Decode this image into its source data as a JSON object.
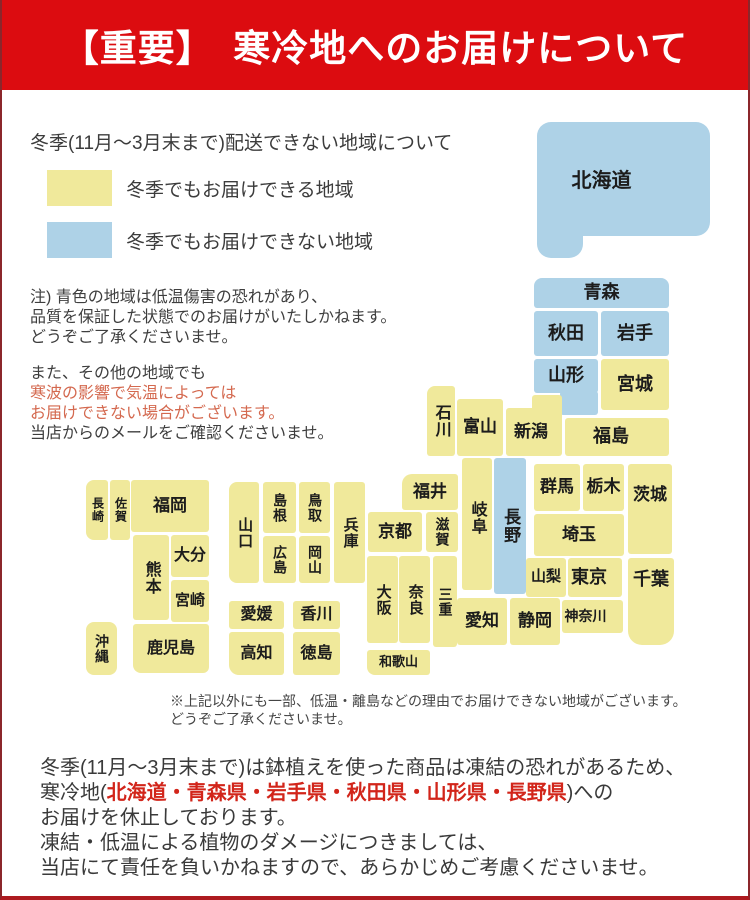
{
  "banner": {
    "title": "【重要】　寒冷地へのお届けについて",
    "bg": "#dc0c10"
  },
  "intro": {
    "heading": "冬季(11月〜3月末まで)配送できない地域について",
    "legend": [
      {
        "key": "deliverable",
        "label": "冬季でもお届けできる地域"
      },
      {
        "key": "not_deliverable",
        "label": "冬季でもお届けできない地域"
      }
    ]
  },
  "notes": {
    "note1": [
      {
        "text": "注) 青色の地域は低温傷害の恐れがあり、"
      },
      {
        "text": "品質を保証した状態でのお届けがいたしかねます。"
      },
      {
        "text": "どうぞご了承くださいませ。"
      }
    ],
    "note2": [
      {
        "text": "また、その他の地域でも"
      },
      {
        "text": "寒波の影響で気温によっては",
        "red": true
      },
      {
        "text": "お届けできない場合がございます。",
        "red": true
      },
      {
        "text": "当店からのメールをご確認くださいませ。"
      }
    ]
  },
  "map": {
    "colors": {
      "deliverable": "#f0e99b",
      "not_deliverable": "#aed2e7"
    },
    "blocks": [
      {
        "id": "hokkaido",
        "label": "北海道",
        "x": 535,
        "y": 122,
        "w": 173,
        "h": 114,
        "c": "b",
        "fs": 20,
        "r": "14px",
        "dx": -22,
        "dy": 3
      },
      {
        "id": "hokkaido-tab",
        "x": 535,
        "y": 200,
        "w": 46,
        "h": 58,
        "c": "b",
        "r": "0 0 14px 14px"
      },
      {
        "id": "aomori",
        "label": "青森",
        "x": 532,
        "y": 278,
        "w": 135,
        "h": 30,
        "c": "b",
        "fs": 18,
        "r": "8px 8px 3px 3px"
      },
      {
        "id": "akita",
        "label": "秋田",
        "x": 532,
        "y": 311,
        "w": 64,
        "h": 45,
        "c": "b",
        "fs": 18
      },
      {
        "id": "iwate",
        "label": "岩手",
        "x": 599,
        "y": 311,
        "w": 68,
        "h": 45,
        "c": "b",
        "fs": 18
      },
      {
        "id": "yamagata",
        "label": "山形",
        "x": 532,
        "y": 359,
        "w": 64,
        "h": 34,
        "c": "b",
        "fs": 18
      },
      {
        "id": "yamagata-ext",
        "x": 558,
        "y": 391,
        "w": 38,
        "h": 24,
        "c": "b"
      },
      {
        "id": "miyagi",
        "label": "宮城",
        "x": 599,
        "y": 359,
        "w": 68,
        "h": 51,
        "c": "y",
        "fs": 18
      },
      {
        "id": "fukushima",
        "label": "福島",
        "x": 563,
        "y": 418,
        "w": 104,
        "h": 38,
        "c": "y",
        "fs": 18,
        "dx": -6
      },
      {
        "id": "niigata",
        "label": "新潟",
        "x": 504,
        "y": 408,
        "w": 56,
        "h": 48,
        "c": "y",
        "fs": 17,
        "dx": -3
      },
      {
        "id": "niigata-ext",
        "x": 530,
        "y": 395,
        "w": 30,
        "h": 20,
        "c": "y"
      },
      {
        "id": "ishikawa",
        "label": "石川",
        "x": 425,
        "y": 386,
        "w": 28,
        "h": 70,
        "c": "y",
        "o": "v",
        "fs": 16,
        "r": "8px 3px 3px 3px"
      },
      {
        "id": "toyama",
        "label": "富山",
        "x": 455,
        "y": 399,
        "w": 46,
        "h": 57,
        "c": "y",
        "fs": 17
      },
      {
        "id": "fukui",
        "label": "福井",
        "x": 400,
        "y": 474,
        "w": 56,
        "h": 36,
        "c": "y",
        "fs": 17,
        "r": "10px 3px 3px 3px"
      },
      {
        "id": "kyoto",
        "label": "京都",
        "x": 366,
        "y": 512,
        "w": 54,
        "h": 40,
        "c": "y",
        "fs": 17
      },
      {
        "id": "shiga",
        "label": "滋賀",
        "x": 424,
        "y": 512,
        "w": 32,
        "h": 40,
        "c": "y",
        "o": "v",
        "fs": 14
      },
      {
        "id": "gifu",
        "label": "岐阜",
        "x": 460,
        "y": 458,
        "w": 30,
        "h": 132,
        "c": "y",
        "o": "v",
        "fs": 16,
        "dy": -6
      },
      {
        "id": "nagano",
        "label": "長野",
        "x": 492,
        "y": 458,
        "w": 32,
        "h": 136,
        "c": "b",
        "o": "v",
        "fs": 17
      },
      {
        "id": "gunma",
        "label": "群馬",
        "x": 532,
        "y": 464,
        "w": 46,
        "h": 47,
        "c": "y",
        "fs": 17
      },
      {
        "id": "tochigi",
        "label": "栃木",
        "x": 581,
        "y": 464,
        "w": 41,
        "h": 47,
        "c": "y",
        "fs": 17
      },
      {
        "id": "ibaraki",
        "label": "茨城",
        "x": 626,
        "y": 464,
        "w": 44,
        "h": 90,
        "c": "y",
        "fs": 17,
        "dy": -14
      },
      {
        "id": "saitama",
        "label": "埼玉",
        "x": 532,
        "y": 514,
        "w": 90,
        "h": 42,
        "c": "y",
        "fs": 17
      },
      {
        "id": "yamanashi",
        "label": "山梨",
        "x": 524,
        "y": 558,
        "w": 40,
        "h": 39,
        "c": "y",
        "fs": 15
      },
      {
        "id": "tokyo",
        "label": "東京",
        "x": 566,
        "y": 558,
        "w": 54,
        "h": 39,
        "c": "y",
        "fs": 18,
        "dx": -6
      },
      {
        "id": "chiba",
        "label": "千葉",
        "x": 626,
        "y": 558,
        "w": 46,
        "h": 87,
        "c": "y",
        "fs": 18,
        "r": "3px 3px 14px 14px",
        "dy": -22
      },
      {
        "id": "kanagawa",
        "label": "神奈川",
        "x": 560,
        "y": 600,
        "w": 61,
        "h": 33,
        "c": "y",
        "fs": 14,
        "dx": -7
      },
      {
        "id": "shizuoka",
        "label": "静岡",
        "x": 508,
        "y": 598,
        "w": 50,
        "h": 47,
        "c": "y",
        "fs": 17
      },
      {
        "id": "aichi",
        "label": "愛知",
        "x": 455,
        "y": 598,
        "w": 50,
        "h": 47,
        "c": "y",
        "fs": 17
      },
      {
        "id": "mie",
        "label": "三重",
        "x": 431,
        "y": 556,
        "w": 24,
        "h": 91,
        "c": "y",
        "o": "v",
        "fs": 14
      },
      {
        "id": "nara",
        "label": "奈良",
        "x": 397,
        "y": 556,
        "w": 31,
        "h": 87,
        "c": "y",
        "o": "v",
        "fs": 15
      },
      {
        "id": "osaka",
        "label": "大阪",
        "x": 365,
        "y": 556,
        "w": 31,
        "h": 87,
        "c": "y",
        "o": "v",
        "fs": 15
      },
      {
        "id": "wakayama",
        "label": "和歌山",
        "x": 365,
        "y": 650,
        "w": 63,
        "h": 25,
        "c": "y",
        "fs": 13,
        "r": "3px 3px 3px 8px"
      },
      {
        "id": "hyogo",
        "label": "兵庫",
        "x": 332,
        "y": 482,
        "w": 31,
        "h": 101,
        "c": "y",
        "o": "v",
        "fs": 15
      },
      {
        "id": "tottori",
        "label": "鳥取",
        "x": 297,
        "y": 482,
        "w": 31,
        "h": 51,
        "c": "y",
        "o": "v",
        "fs": 14
      },
      {
        "id": "okayama",
        "label": "岡山",
        "x": 297,
        "y": 536,
        "w": 31,
        "h": 47,
        "c": "y",
        "o": "v",
        "fs": 14
      },
      {
        "id": "shimane",
        "label": "島根",
        "x": 261,
        "y": 482,
        "w": 33,
        "h": 51,
        "c": "y",
        "o": "v",
        "fs": 14
      },
      {
        "id": "hiroshima",
        "label": "広島",
        "x": 261,
        "y": 536,
        "w": 33,
        "h": 47,
        "c": "y",
        "o": "v",
        "fs": 14
      },
      {
        "id": "yamaguchi",
        "label": "山口",
        "x": 227,
        "y": 482,
        "w": 30,
        "h": 101,
        "c": "y",
        "o": "v",
        "fs": 15,
        "r": "8px 3px 3px 8px"
      },
      {
        "id": "ehime",
        "label": "愛媛",
        "x": 227,
        "y": 601,
        "w": 55,
        "h": 28,
        "c": "y",
        "fs": 16
      },
      {
        "id": "kagawa",
        "label": "香川",
        "x": 291,
        "y": 601,
        "w": 47,
        "h": 28,
        "c": "y",
        "fs": 16
      },
      {
        "id": "kochi",
        "label": "高知",
        "x": 227,
        "y": 632,
        "w": 55,
        "h": 43,
        "c": "y",
        "fs": 16,
        "r": "3px 3px 3px 10px"
      },
      {
        "id": "tokushima",
        "label": "徳島",
        "x": 291,
        "y": 632,
        "w": 47,
        "h": 43,
        "c": "y",
        "fs": 16
      },
      {
        "id": "fukuoka",
        "label": "福岡",
        "x": 129,
        "y": 480,
        "w": 78,
        "h": 52,
        "c": "y",
        "fs": 17
      },
      {
        "id": "saga",
        "label": "佐賀",
        "x": 108,
        "y": 480,
        "w": 20,
        "h": 60,
        "c": "y",
        "o": "v",
        "fs": 12
      },
      {
        "id": "nagasaki",
        "label": "長崎",
        "x": 84,
        "y": 480,
        "w": 22,
        "h": 60,
        "c": "y",
        "o": "v",
        "fs": 12,
        "r": "8px 3px 3px 8px"
      },
      {
        "id": "kumamoto",
        "label": "熊本",
        "x": 131,
        "y": 535,
        "w": 36,
        "h": 85,
        "c": "y",
        "o": "v",
        "fs": 16
      },
      {
        "id": "oita",
        "label": "大分",
        "x": 169,
        "y": 535,
        "w": 38,
        "h": 42,
        "c": "y",
        "fs": 16
      },
      {
        "id": "miyazaki",
        "label": "宮崎",
        "x": 169,
        "y": 580,
        "w": 38,
        "h": 42,
        "c": "y",
        "fs": 15
      },
      {
        "id": "kagoshima",
        "label": "鹿児島",
        "x": 131,
        "y": 624,
        "w": 76,
        "h": 49,
        "c": "y",
        "fs": 16,
        "r": "3px 3px 6px 8px"
      },
      {
        "id": "okinawa",
        "label": "沖縄",
        "x": 84,
        "y": 622,
        "w": 31,
        "h": 53,
        "c": "y",
        "o": "v",
        "fs": 14,
        "r": "8px"
      }
    ]
  },
  "footnote": [
    {
      "text": "※上記以外にも一部、低温・離島などの理由でお届けできない地域がございます。"
    },
    {
      "text": "どうぞご了承くださいませ。"
    }
  ],
  "footer": {
    "line1": "冬季(11月〜3月末まで)は鉢植えを使った商品は凍結の恐れがあるため、",
    "line2_prefix": "寒冷地(",
    "line2_red": "北海道・青森県・岩手県・秋田県・山形県・長野県",
    "line2_suffix": ")への",
    "line3": "お届けを休止しております。",
    "line4": "凍結・低温による植物のダメージにつきましては、",
    "line5": "当店にて責任を負いかねますので、あらかじめご考慮くださいませ。"
  }
}
